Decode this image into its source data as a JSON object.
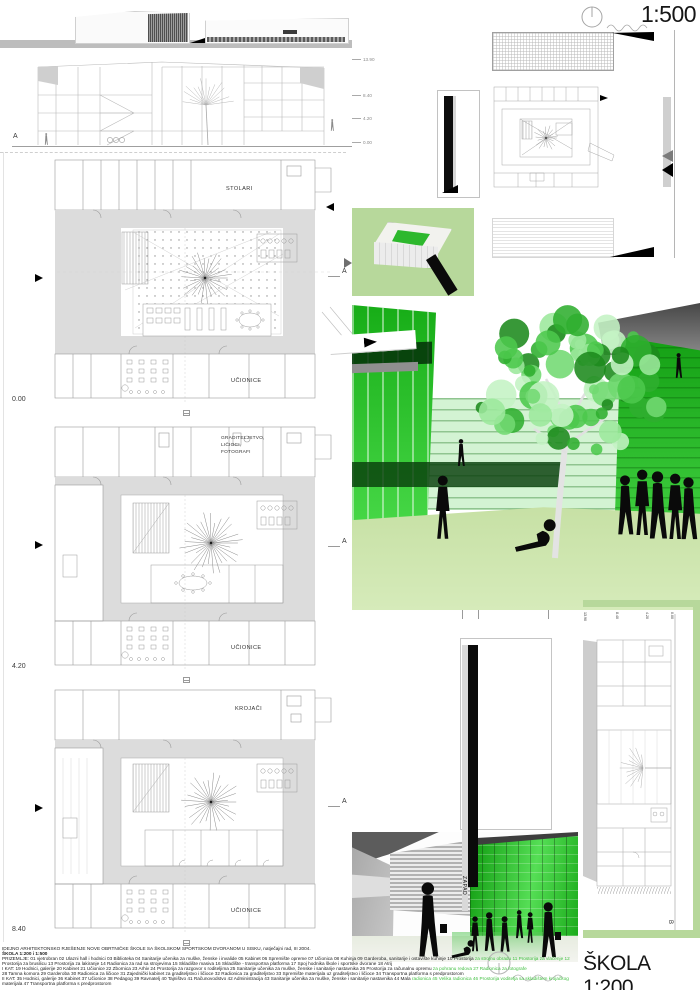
{
  "board": {
    "scale_label_500": "1:500",
    "scale_label_200": "ŠKOLA 1:200"
  },
  "top_section": {
    "marker": "A",
    "levels": [
      "13.90",
      "8.40",
      "4.20",
      "0.00"
    ]
  },
  "plans": [
    {
      "level": "0.00",
      "marker": "A",
      "top_label_lines": [
        "STOLARI"
      ],
      "bottom_label": "UČIONICE"
    },
    {
      "level": "4.20",
      "marker": "A",
      "top_label_lines": [
        "GRADITELJSTVO,",
        "LIČIOCI,",
        "FOTOGRAFI"
      ],
      "bottom_label": "UČIONICE"
    },
    {
      "level": "8.40",
      "marker": "A",
      "top_label_lines": [
        "KROJAČI"
      ],
      "bottom_label": "UČIONICE"
    }
  ],
  "section_b": {
    "marker": "B",
    "levels": [
      "13.90",
      "8.40",
      "4.20",
      "0.00"
    ]
  },
  "render": {
    "tower_label": "ZAPAD"
  },
  "legend": {
    "title": "IDEJNO ARHITEKTONSKO RJEŠENJE NOVE OBRTNIČKE ŠKOLE SA ŠKOLSKOM SPORTSKOM DVORANOM U SISKU, natječajni rad, III 2004.",
    "subtitle": "ŠKOLA 1:200 i 1:500",
    "lines": [
      {
        "black": "PRIZEMLJE: 01 vjetrobran 02 Ulazni hall i hodnici 03 Biblioteka 04 Sanitarije učenika za muške, ženske i invalide 05 Kabinet 06 Spremište opreme 07 Učionica 08 Kuhinja 09 Garderoba, sanitarije i ostavište kuhinje 10 Prostorija",
        "green": " za strojnu obradu 11 Prostorija za vlačenje 12"
      },
      {
        "black": "Prostorija za brusilicu 13 Prostorija za lakiranje 14 Radionica za rad sa strojevima 15 Skladište masiva 16 Skladište - transportna platforma 17 Spoj hodnika škole i sportske dvorane 18 Atrij",
        "green": ""
      },
      {
        "black": "I KAT: 19 Hodnici, galerije 20 Kabinet 21 Učionice 22 Zbornica 23 Arhiv 24 Prostorija za razgovor s roditeljima 25 Sanitarije učenika za muške, ženske i sanitarije nastavnika 26 Prostorija za računalnu opremu",
        "green": " za pohranu redova 27 Radionica za fotografe"
      },
      {
        "black": "28 Tamna komora 29 Garderoba 30 Radionica za ličioce 31 Zajednički kabinet za graditeljstvo i ličioce 32 Radionica za graditeljstvo 33 Spremište materijala uz graditeljstvo i ličioce 34 Transportna platforma s predprostorom",
        "green": ""
      },
      {
        "black": "II KAT: 35 Hodnici, galerije 36 Kabinet 37 Učionice 38 Pedagog 39 Ravnatelj 40 Tajništvo 41 Računovodstvo 42 Administracija 43 Sanitarije učenika za muške, ženske i sanitarije nastavnika 44 Mala",
        "green": " radionica 45 Velika radionica 46 Prostorija voditelja sa skladištem krojačkog"
      },
      {
        "black": "materijala 47 Transportna platforma s predprostorom",
        "green": ""
      }
    ]
  },
  "colors": {
    "accent_green": "#2ec82e",
    "panel_green": "#b7d89b",
    "ground_green": "#cfe6ae"
  }
}
